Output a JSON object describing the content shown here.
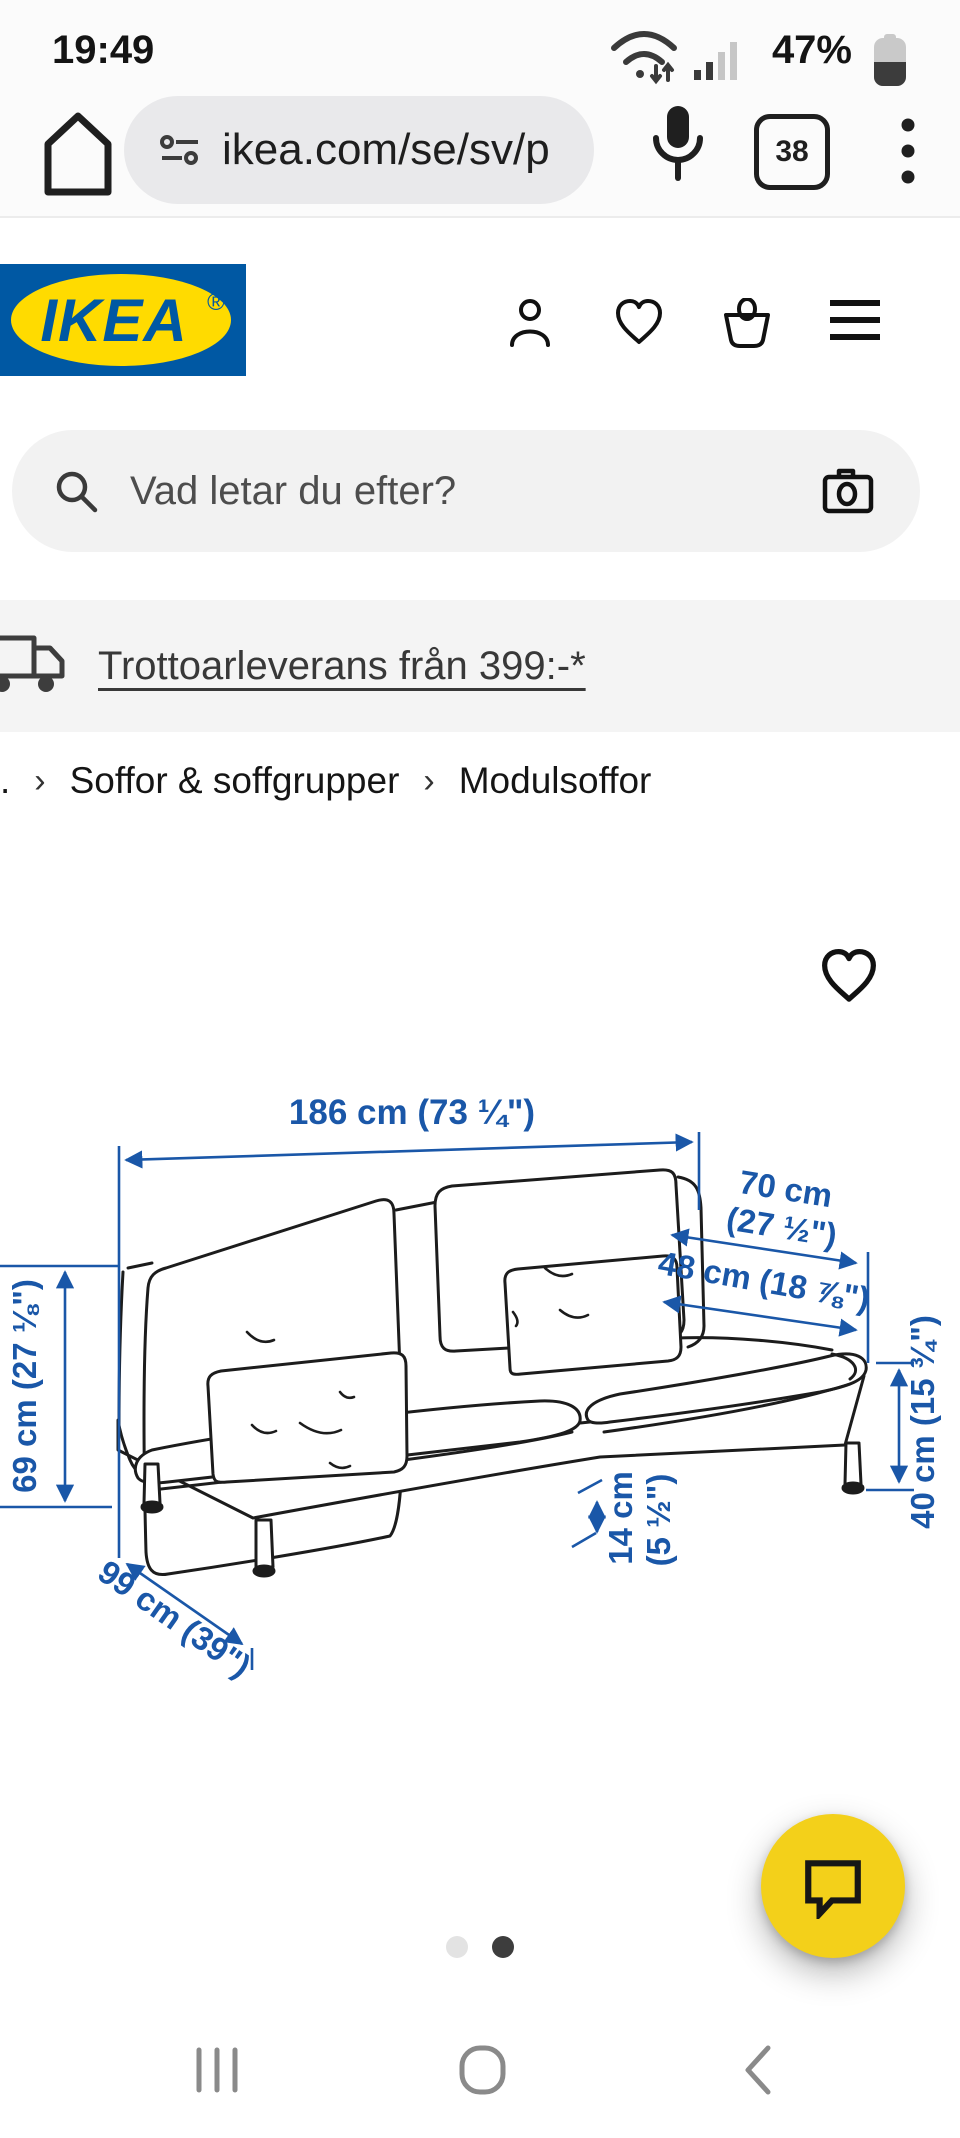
{
  "status_bar": {
    "time": "19:49",
    "battery": "47%"
  },
  "browser_bar": {
    "url": "ikea.com/se/sv/p",
    "tab_count": "38"
  },
  "site_header": {
    "logo_text": "IKEA",
    "logo_registered": "®"
  },
  "search_bar": {
    "placeholder": "Vad letar du efter?"
  },
  "delivery_banner": {
    "link": "Trottoarleverans från 399:-*"
  },
  "breadcrumb": {
    "separator": "›",
    "items": [
      ".",
      "Soffor & soffgrupper",
      "Modulsoffor"
    ]
  },
  "product_diagram": {
    "dimensions": {
      "total_width": "186 cm (73 ¼\")",
      "depth_line1": "70 cm",
      "depth_line2": "(27 ½\")",
      "seat_depth": "48 cm (18 ⅞\")",
      "back_height": "69 cm (27 ⅛\")",
      "leg_clearance_line1": "14 cm",
      "leg_clearance_line2": "(5 ½\")",
      "seat_height": "40 cm (15 ¾\")",
      "total_depth": "99 cm (39\")"
    }
  },
  "carousel": {
    "dot_count": 2,
    "active_index": 1
  },
  "icons": {
    "home": "house-outline",
    "url_security": "tune-sliders",
    "microphone": "mic",
    "tab_switcher": "rounded-square-count",
    "menu": "kebab-dots",
    "profile": "person-outline",
    "wishlist": "heart-outline",
    "cart": "basket-outline",
    "nav_menu": "hamburger",
    "search": "magnifier",
    "visual_search": "camera-outline",
    "delivery": "truck-outline",
    "favorite": "heart-outline",
    "chat": "speech-bubble",
    "nav_recents": "three-vertical-bars",
    "nav_home": "rounded-square",
    "nav_back": "chevron-left",
    "wifi": "wifi-arcs",
    "signal": "signal-bars",
    "battery": "vertical-battery"
  },
  "colors": {
    "ikea_blue": "#0058A3",
    "ikea_yellow": "#FFDB00",
    "dimension_blue": "#1a57a8",
    "chat_fab_yellow": "#F3D01A",
    "banner_bg": "#f4f4f4",
    "url_pill_bg": "#e9e9eb"
  }
}
